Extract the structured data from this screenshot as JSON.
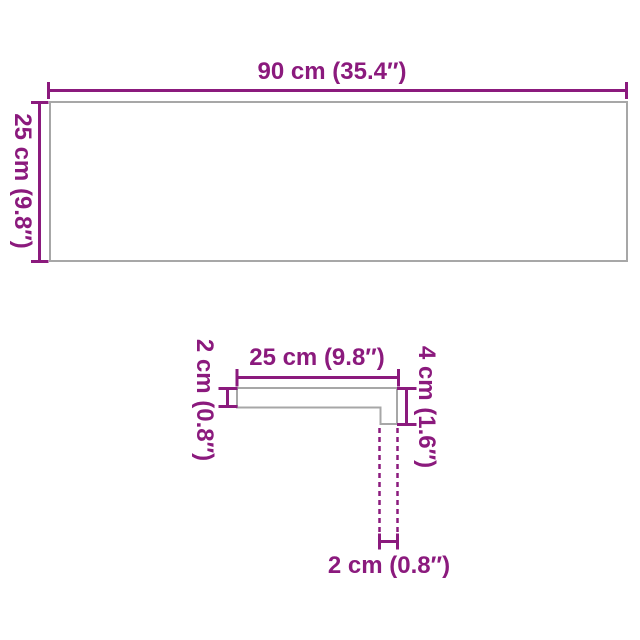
{
  "page": {
    "background": "#FFFFFF"
  },
  "diagram": {
    "colors": {
      "dimension": "#8B1A7D",
      "outline": "#A7A7A7"
    },
    "panel": {
      "width_label": "90 cm (35.4″)",
      "height_label": "25 cm (9.8″)"
    },
    "profile": {
      "width_label": "25 cm (9.8″)",
      "thickness_label": "2 cm (0.8″)",
      "edge_height_label": "4 cm (1.6″)",
      "edge_thickness_label": "2 cm (0.8″)"
    }
  }
}
